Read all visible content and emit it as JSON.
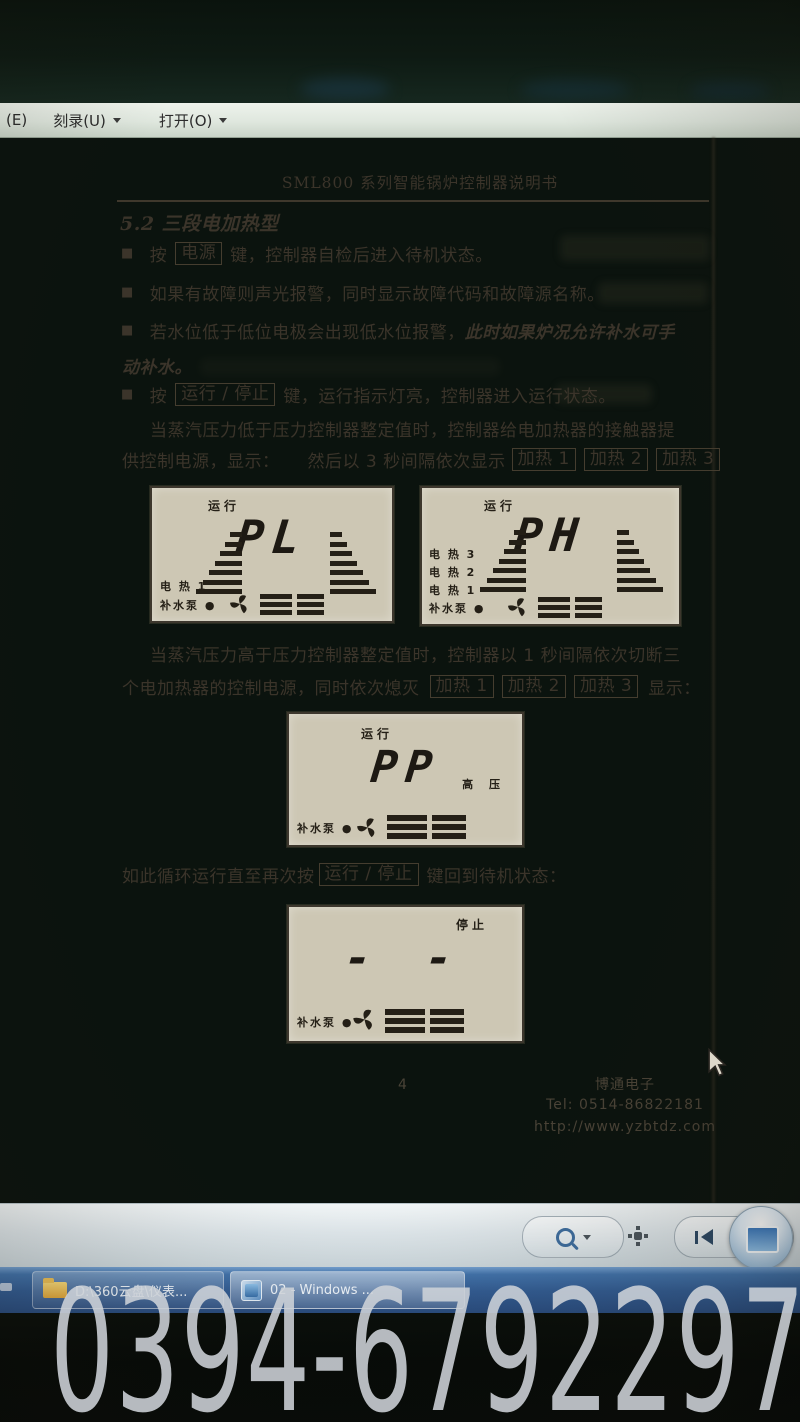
{
  "window": {
    "menu_items": [
      {
        "label": "(E)"
      },
      {
        "label": "刻录(U)"
      },
      {
        "label": "打开(O)"
      }
    ]
  },
  "doc": {
    "bullet_char": "■",
    "title": "SML800 系列智能锅炉控制器说明书",
    "heading": "5.2 三段电加热型",
    "b1_pre": "按",
    "b1_key": "电源",
    "b1_post": "键，控制器自检后进入待机状态。",
    "b2": "如果有故障则声光报警，同时显示故障代码和故障源名称。",
    "b3_pre": "若水位低于低位电极会出现低水位报警，",
    "b3_italic": "此时如果炉况允许补水可手",
    "b3_line2": "动补水。",
    "b4_pre": "按",
    "b4_key": "运行 / 停止",
    "b4_post": "键，运行指示灯亮，控制器进入运行状态。",
    "p1_line1": "当蒸汽压力低于压力控制器整定值时，控制器给电加热器的接触器提",
    "p1_line2a": "供控制电源，显示：",
    "p1_line2b": "然后以 3 秒间隔依次显示",
    "heat_keys": [
      "加热 1",
      "加热 2",
      "加热 3"
    ],
    "p2_line1": "当蒸汽压力高于压力控制器整定值时，控制器以 1 秒间隔依次切断三",
    "p2_line2a": "个电加热器的控制电源，同时依次熄灭",
    "p2_line2b": "显示：",
    "cycle_pre": "如此循环运行直至再次按",
    "cycle_key": "运行 / 停止",
    "cycle_post": "键回到待机状态："
  },
  "lcd_pl": {
    "status": "运行",
    "value": "PL",
    "labels": [
      "电 热 1",
      "补水泵 ●"
    ]
  },
  "lcd_ph": {
    "status": "运行",
    "value": "PH",
    "labels": [
      "电 热 3",
      "电 热 2",
      "电 热 1",
      "补水泵 ●"
    ]
  },
  "lcd_pp": {
    "status": "运行",
    "value": "PP",
    "side_label": "高 压",
    "labels": [
      "补水泵 ●"
    ]
  },
  "lcd_stop": {
    "status": "停止",
    "value": "- -",
    "labels": [
      "补水泵 ●"
    ]
  },
  "footer": {
    "page": "4",
    "company": "博通电子",
    "tel": "Tel: 0514-86822181",
    "url": "http://www.yzbtdz.com"
  },
  "taskbar": {
    "item1": "D:\\360云盘\\仪表...",
    "item2": "02 - Windows ..."
  },
  "watermark": "0394-6792297",
  "colors": {
    "taskbar_blue": "#3f6fa8",
    "paper": "#c9c2ae",
    "ink": "#3b342a",
    "watermark_gray": "#ced3d8"
  }
}
